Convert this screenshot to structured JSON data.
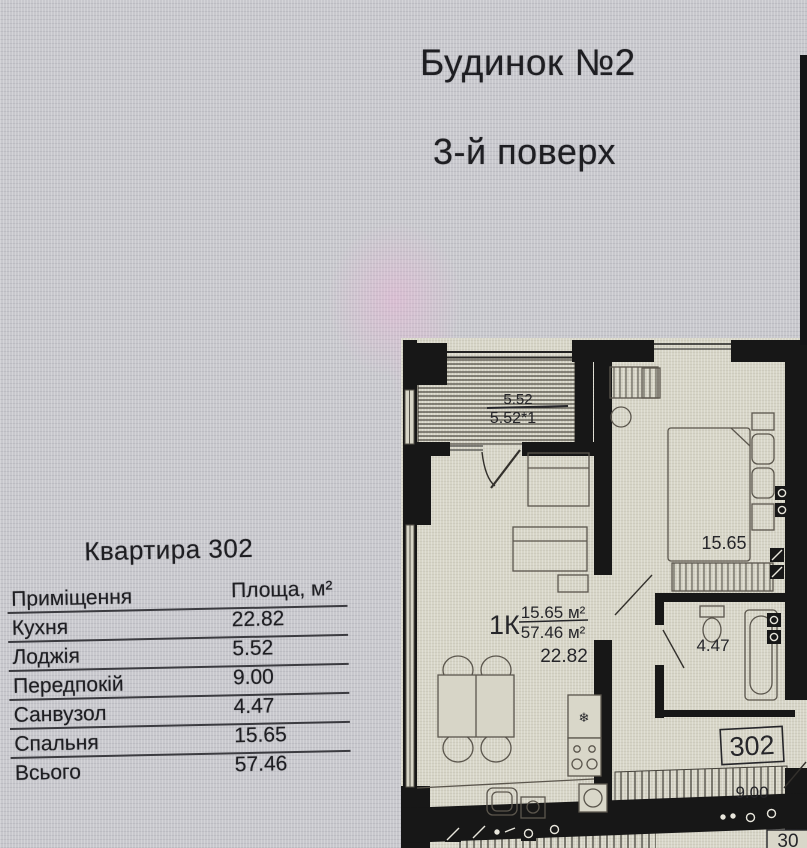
{
  "page": {
    "building_title": "Будинок №2",
    "floor_title": "3-й поверх"
  },
  "apartment": {
    "heading": "Квартира 302",
    "table": {
      "col_room": "Приміщення",
      "col_area": "Площа, м²",
      "rows": [
        {
          "name": "Кухня",
          "area": "22.82"
        },
        {
          "name": "Лоджія",
          "area": "5.52"
        },
        {
          "name": "Передпокій",
          "area": "9.00"
        },
        {
          "name": "Санвузол",
          "area": "4.47"
        },
        {
          "name": "Спальня",
          "area": "15.65"
        },
        {
          "name": "Всього",
          "area": "57.46"
        }
      ]
    }
  },
  "plan": {
    "loggia_area_full": "5.52",
    "loggia_area_coeff": "5.52*1",
    "unit_type": "1К",
    "living_area": "15.65 м²",
    "total_area": "57.46 м²",
    "kitchen_label": "22.82",
    "bedroom_label": "15.65",
    "bathroom_label": "4.47",
    "hall_label": "9.00",
    "apartment_number": "302",
    "adjacent_number_partial": "30"
  },
  "icons": {
    "fridge_snowflake": "❄"
  },
  "colors": {
    "background": "#c8c8cd",
    "plan_paper": "#d7d5c7",
    "wall": "#171717",
    "text": "#222226",
    "smudge_pink": "#f0aed8"
  }
}
